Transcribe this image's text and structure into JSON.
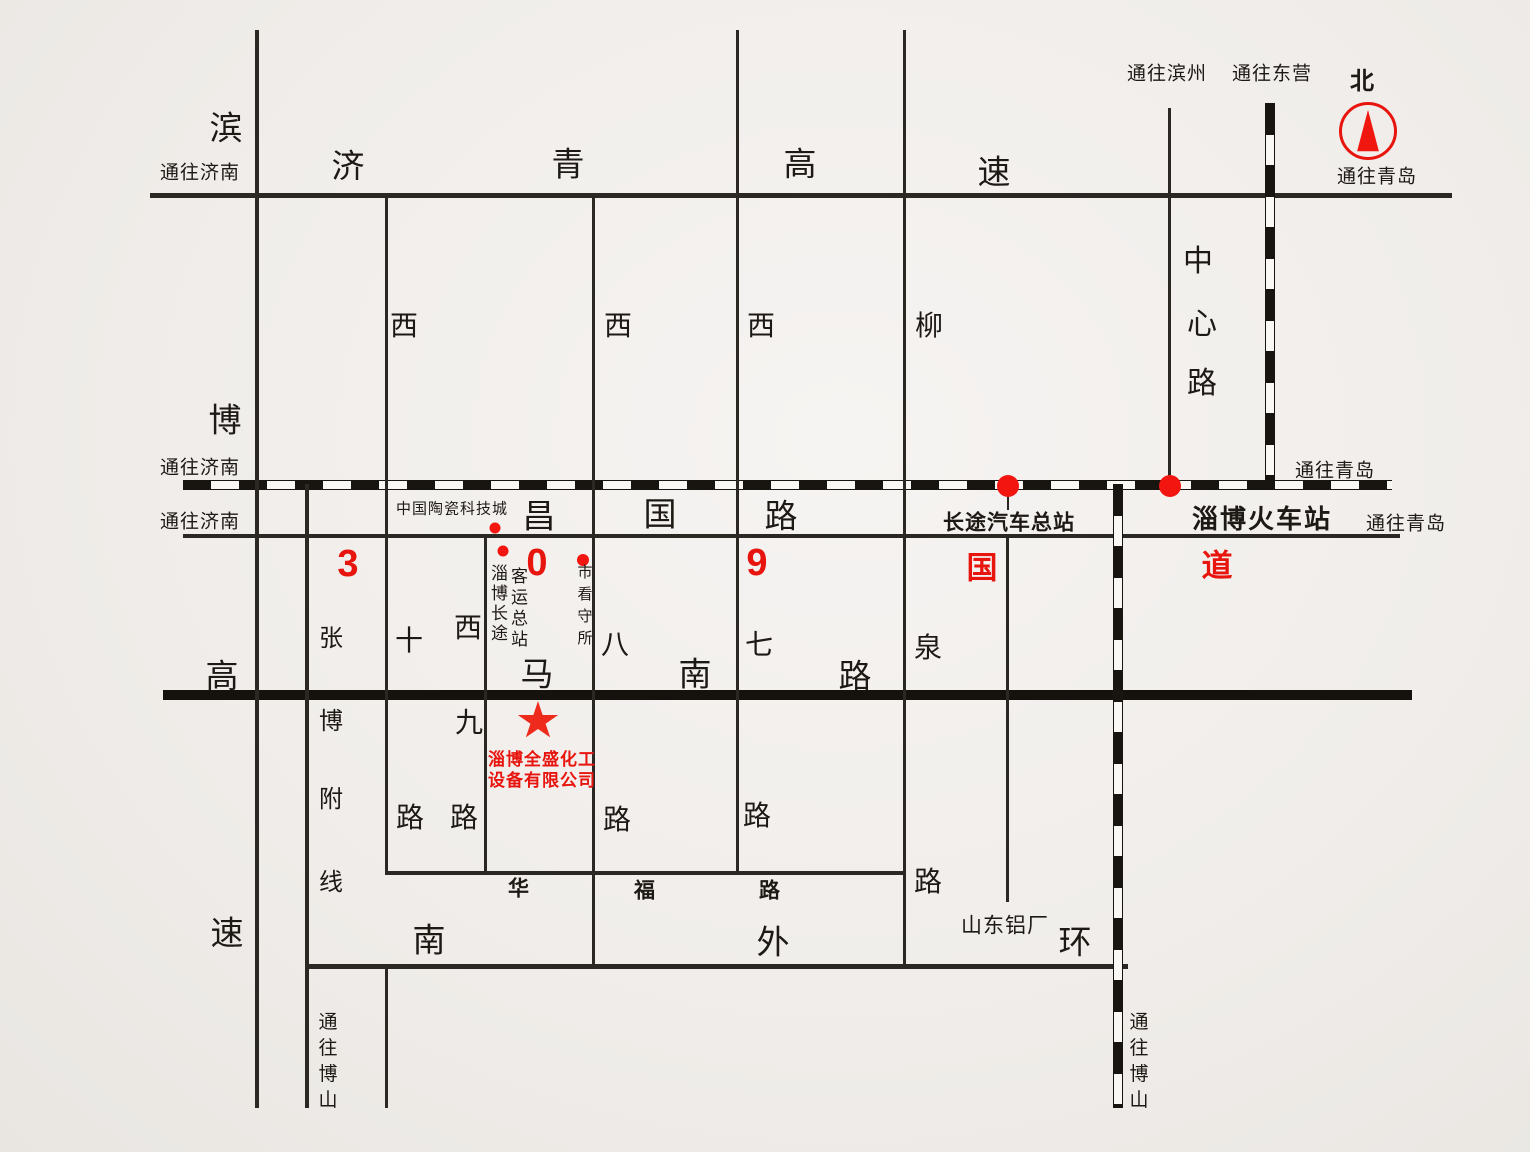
{
  "company": {
    "name_line1": "淄博全盛化工",
    "name_line2": "设备有限公司"
  },
  "compass": {
    "north": "北"
  },
  "directions": {
    "to_jinan": "通往济南",
    "to_qingdao": "通往青岛",
    "to_binzhou": "通往滨州",
    "to_dongying": "通往东营",
    "to_boshan_chars": [
      "通",
      "往",
      "博",
      "山"
    ]
  },
  "roads": {
    "jiqing_expwy": {
      "name": "济青高速",
      "chars": [
        "济",
        "青",
        "高",
        "速"
      ]
    },
    "binbo_expwy": {
      "name": "滨博高速",
      "chars": [
        "滨",
        "博",
        "高",
        "速"
      ]
    },
    "zhangbo_branch": {
      "name": "张博附线",
      "chars": [
        "张",
        "博",
        "附",
        "线"
      ]
    },
    "changguo": {
      "name": "昌国路",
      "chars": [
        "昌",
        "国",
        "路"
      ]
    },
    "g309": {
      "name": "309国道",
      "chars": [
        "3",
        "0",
        "9",
        "国",
        "道"
      ]
    },
    "xi10": {
      "name": "西十路",
      "chars": [
        "西",
        "十",
        "路"
      ]
    },
    "xi9": {
      "name": "西九路",
      "chars": [
        "西",
        "九",
        "路"
      ]
    },
    "xi8": {
      "name": "西八路",
      "chars": [
        "西",
        "八",
        "路"
      ]
    },
    "xi7": {
      "name": "西七路",
      "chars": [
        "西",
        "七",
        "路"
      ]
    },
    "liuquan": {
      "name": "柳泉路",
      "chars": [
        "柳",
        "泉",
        "路"
      ]
    },
    "manan": {
      "name": "马南路",
      "chars": [
        "马",
        "南",
        "路"
      ]
    },
    "huafu": {
      "name": "华福路",
      "chars": [
        "华",
        "福",
        "路"
      ]
    },
    "nanwaihuan": {
      "name": "南外环",
      "chars": [
        "南",
        "外",
        "环"
      ]
    },
    "zhongxin": {
      "name": "中心路",
      "chars": [
        "中",
        "心",
        "路"
      ]
    }
  },
  "landmarks": {
    "ceramics_city": "中国陶瓷科技城",
    "bus_terminal_cols": [
      [
        "淄",
        "博",
        "长",
        "途"
      ],
      [
        "客",
        "运",
        "总",
        "站"
      ]
    ],
    "detention_chars": [
      "市",
      "看",
      "守",
      "所"
    ],
    "longdist_bus_station": "长途汽车总站",
    "railway_station": "淄博火车站",
    "aluminum_plant": "山东铝厂"
  },
  "colors": {
    "accent_red": "#e8150f",
    "road_black": "#2b2723"
  }
}
